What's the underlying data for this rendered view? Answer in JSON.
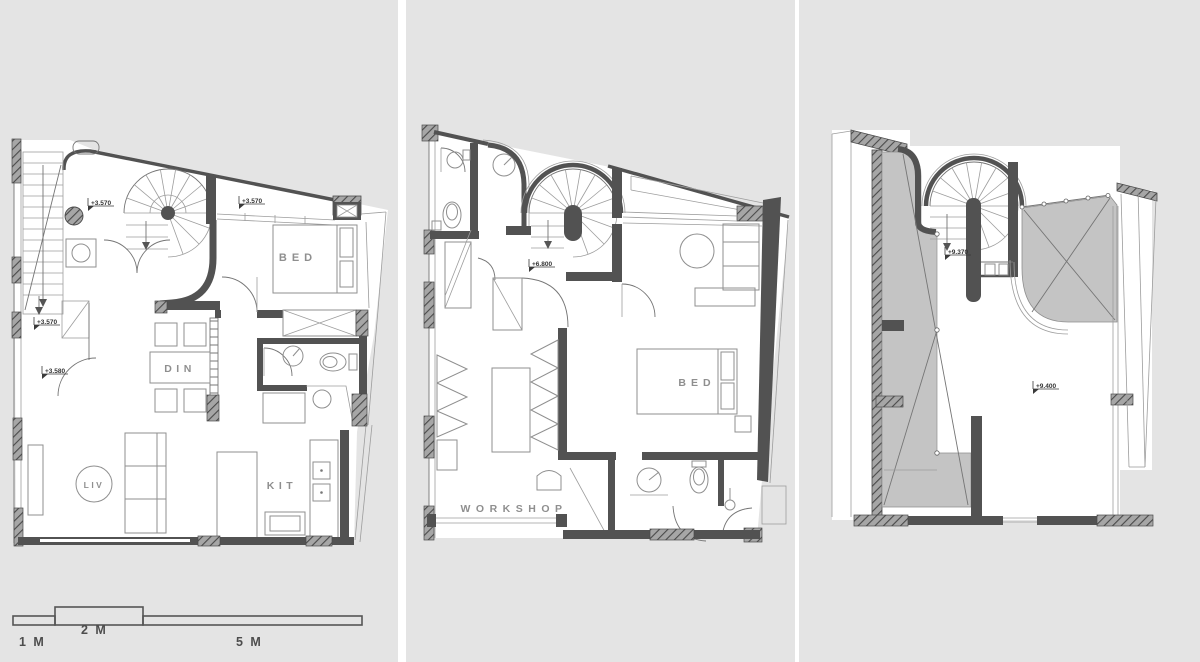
{
  "colors": {
    "background": "#e4e4e4",
    "separator": "#ffffff",
    "wall": "#525252",
    "roof_shade": "#c4c4c4",
    "room_label": "#8f8f8f",
    "marker_text": "#333333"
  },
  "icons": {
    "level_marker_icon": "elevation flag",
    "stair_direction_icon": "down arrow"
  },
  "plans": {
    "left": {
      "rooms": {
        "bed": "BED",
        "din": "DIN",
        "liv": "LIV",
        "kit": "KIT"
      },
      "markers": {
        "m1": "+3.570",
        "m2": "+3.570",
        "m3": "+3.570",
        "m4": "+3.580"
      }
    },
    "middle": {
      "rooms": {
        "bed": "BED",
        "workshop": "WORKSHOP"
      },
      "markers": {
        "m1": "+6.800"
      }
    },
    "right": {
      "markers": {
        "m1": "+9.370",
        "m2": "+9.400"
      }
    }
  },
  "scale_bar": {
    "seg1": "1 M",
    "seg2": "2 M",
    "seg3": "5 M"
  }
}
